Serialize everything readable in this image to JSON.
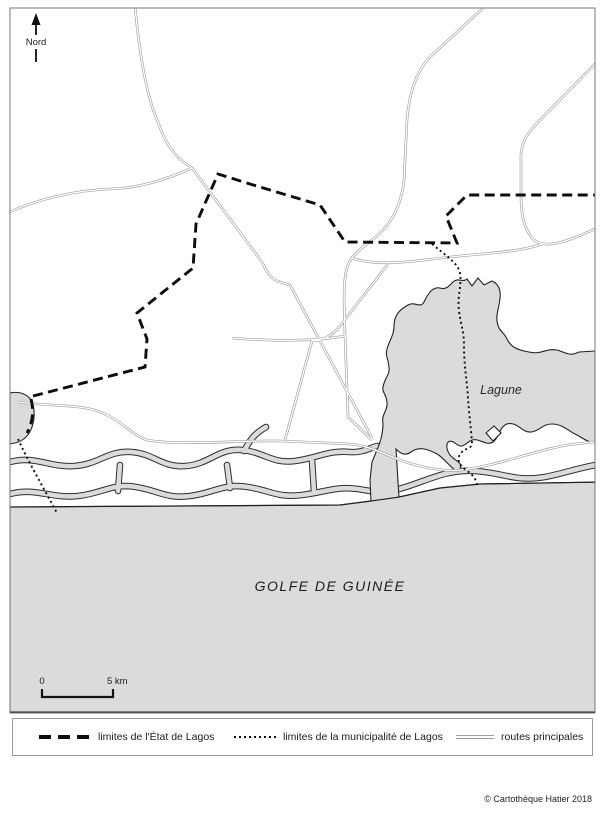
{
  "map": {
    "north_label": "Nord",
    "labels": {
      "lagoon": "Lagune",
      "gulf": "GOLFE DE GUINÉE"
    },
    "scale_bar": {
      "start": "0",
      "end": "5 km"
    }
  },
  "legend": {
    "items": [
      {
        "id": "state-limits",
        "symbol": "thick-dashed-line",
        "label": "limites de l'État de Lagos"
      },
      {
        "id": "municipality-limits",
        "symbol": "dotted-line",
        "label": "limites de la municipalité de Lagos"
      },
      {
        "id": "main-roads",
        "symbol": "double-thin-line",
        "label": "routes principales"
      }
    ]
  },
  "footer": {
    "copyright": "© Cartothèque Hatier 2018"
  },
  "colors": {
    "water_fill": "#dbdbdb",
    "line_dark": "#1c1c1c",
    "road_gray": "#9e9e9e"
  }
}
